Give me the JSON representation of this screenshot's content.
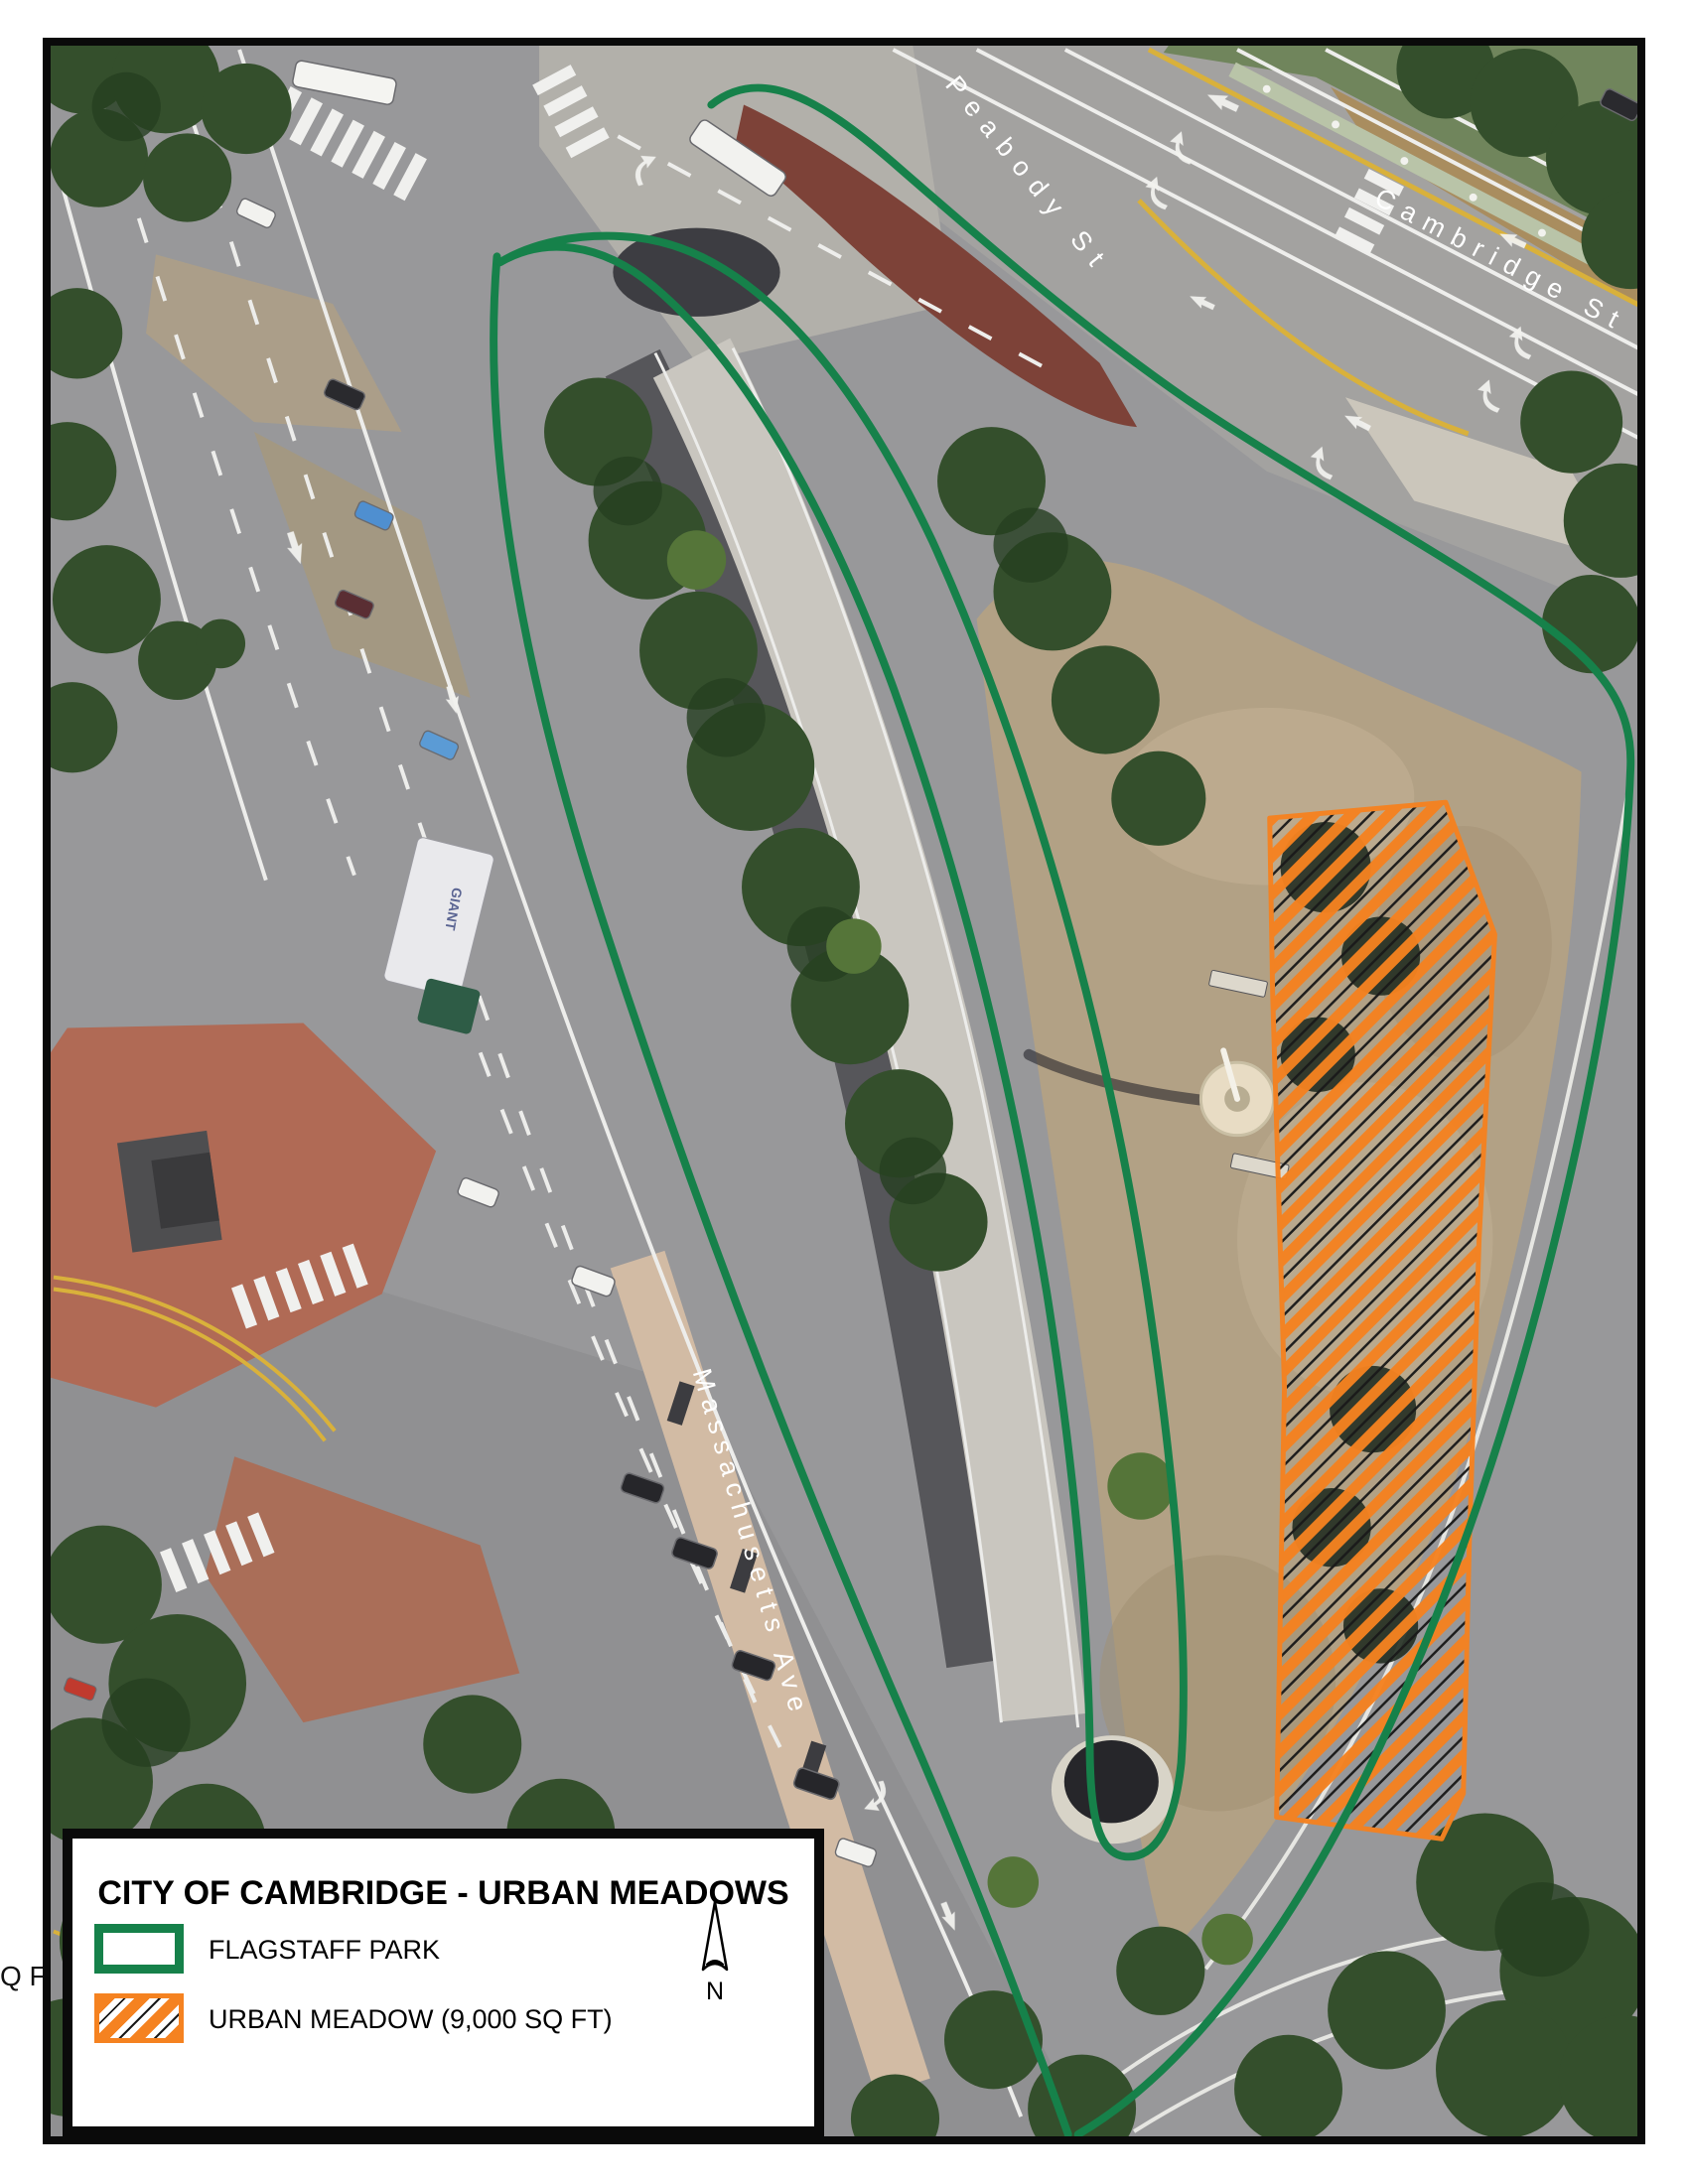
{
  "legend": {
    "title": "CITY OF CAMBRIDGE - URBAN MEADOWS",
    "items": [
      {
        "id": "flagstaff-park",
        "label": "FLAGSTAFF PARK",
        "swatch_style": "green-outline",
        "color": "#16814a"
      },
      {
        "id": "urban-meadow",
        "label": "URBAN MEADOW (9,000 SQ FT)",
        "swatch_style": "orange-diagonal-hatch",
        "color": "#f58220"
      }
    ],
    "north_label": "N"
  },
  "map": {
    "street_labels": [
      {
        "id": "peabody",
        "text": "Peabody St"
      },
      {
        "id": "cambridge",
        "text": "Cambridge St"
      },
      {
        "id": "massachusetts",
        "text": "Massachusetts Ave"
      }
    ],
    "truck_logo": "GIANT",
    "margin_clipped_text": "Q FT)"
  },
  "colors": {
    "park_outline_green": "#16814a",
    "meadow_orange": "#f58220",
    "asphalt_gray": "#98989a"
  }
}
